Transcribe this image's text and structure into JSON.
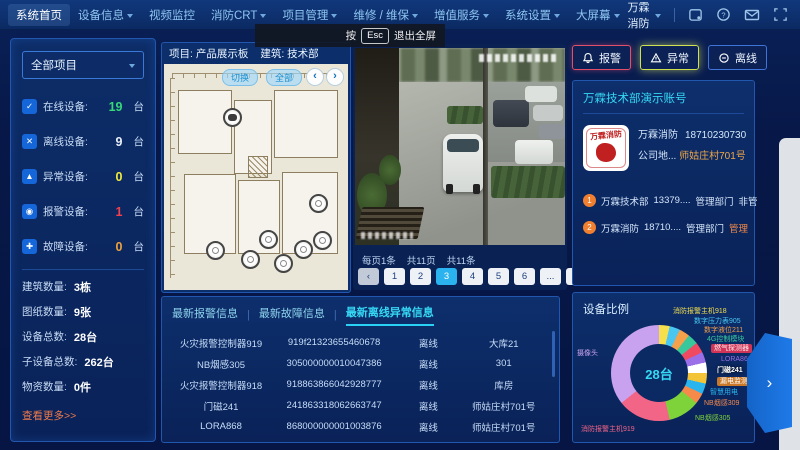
{
  "nav": {
    "items": [
      {
        "label": "系统首页"
      },
      {
        "label": "设备信息"
      },
      {
        "label": "视频监控"
      },
      {
        "label": "消防CRT"
      },
      {
        "label": "项目管理"
      },
      {
        "label": "维修 / 维保"
      },
      {
        "label": "增值服务"
      },
      {
        "label": "系统设置"
      },
      {
        "label": "大屏幕"
      }
    ],
    "user": "万霖消防",
    "icon_names": [
      "notification-icon",
      "help-icon",
      "mail-icon",
      "fullscreen-icon"
    ]
  },
  "tooltip": {
    "press": "按",
    "key": "Esc",
    "action": "退出全屏"
  },
  "sidebar": {
    "project_selector": "全部项目",
    "stats": [
      {
        "label": "在线设备:",
        "value": "19",
        "unit": "台",
        "color": "#35d977",
        "glyph": "✓"
      },
      {
        "label": "离线设备:",
        "value": "9",
        "unit": "台",
        "color": "#e9eff6",
        "glyph": "✕"
      },
      {
        "label": "异常设备:",
        "value": "0",
        "unit": "台",
        "color": "#f2ec3a",
        "glyph": "▲"
      },
      {
        "label": "报警设备:",
        "value": "1",
        "unit": "台",
        "color": "#f0414e",
        "glyph": "◉"
      },
      {
        "label": "故障设备:",
        "value": "0",
        "unit": "台",
        "color": "#f0a23a",
        "glyph": "✚"
      }
    ],
    "summary": [
      {
        "label": "建筑数量:",
        "value": "3栋"
      },
      {
        "label": "图纸数量:",
        "value": "9张"
      },
      {
        "label": "设备总数:",
        "value": "28台"
      },
      {
        "label": "子设备总数:",
        "value": "262台"
      },
      {
        "label": "物资数量:",
        "value": "0件"
      }
    ],
    "more_link": "查看更多>>"
  },
  "plan": {
    "project": "项目: 产品展示板",
    "building": "建筑: 技术部",
    "switch_btn": "切换",
    "all_btn": "全部",
    "prev": "‹",
    "next": "›"
  },
  "pagination": {
    "per_page": "每页1条",
    "total_pages": "共11页",
    "total_items": "共11条",
    "prev": "‹",
    "pages": [
      "1",
      "2",
      "3",
      "4",
      "5",
      "6",
      "...",
      "11"
    ],
    "active_page": "3",
    "next": "›"
  },
  "tabs": {
    "separator": "|",
    "items": [
      "最新报警信息",
      "最新故障信息",
      "最新离线异常信息"
    ]
  },
  "table": {
    "rows": [
      {
        "name": "火灾报警控制器919",
        "id": "919f21323655460678",
        "status": "离线",
        "location": "大库21"
      },
      {
        "name": "NB烟感305",
        "id": "305000000010047386",
        "status": "离线",
        "location": "301"
      },
      {
        "name": "火灾报警控制器918",
        "id": "918863866042928777",
        "status": "离线",
        "location": "库房"
      },
      {
        "name": "门磁241",
        "id": "241863318062663747",
        "status": "离线",
        "location": "师姑庄村701号"
      },
      {
        "name": "LORA868",
        "id": "868000000001003876",
        "status": "离线",
        "location": "师姑庄村701号"
      }
    ]
  },
  "right_buttons": [
    {
      "label": "报警",
      "icon": "alarm-bell-icon",
      "accent": "#e0506a"
    },
    {
      "label": "异常",
      "icon": "warning-triangle-icon",
      "accent": "#cfe050"
    },
    {
      "label": "离线",
      "icon": "circle-minus-icon",
      "accent": "#3f74d8"
    }
  ],
  "account": {
    "title": "万霖技术部演示账号",
    "logo_text": "万霖消防",
    "company": "万霖消防",
    "phone": "18710230730",
    "address_label": "公司地...",
    "address": "师姑庄村701号",
    "members": [
      {
        "num": "1",
        "name": "万霖技术部",
        "phone": "13379....",
        "dept": "管理部门",
        "role": "非管"
      },
      {
        "num": "2",
        "name": "万霖消防",
        "phone": "18710....",
        "dept": "管理部门",
        "role": "管理"
      }
    ]
  },
  "chart_data": {
    "type": "pie",
    "subtype": "donut",
    "title": "设备比例",
    "center_label": "28台",
    "total": 28,
    "legend_position": "around",
    "slices": [
      {
        "label": "消防报警主机918",
        "value": 1,
        "color": "#f5df4d"
      },
      {
        "label": "数字压力表905",
        "value": 1,
        "color": "#49c6f2"
      },
      {
        "label": "数字液位211",
        "value": 1,
        "color": "#f5a04a"
      },
      {
        "label": "4G控制模块",
        "value": 1,
        "color": "#39c89b"
      },
      {
        "label": "燃气探测器",
        "value": 1,
        "color": "#ef4a62"
      },
      {
        "label": "LORA868",
        "value": 1,
        "color": "#9a6fe8"
      },
      {
        "label": "门磁241",
        "value": 1,
        "color": "#ffffff"
      },
      {
        "label": "漏电监测",
        "value": 1,
        "color": "#f3c438"
      },
      {
        "label": "智慧用电",
        "value": 1,
        "color": "#2ab5ee"
      },
      {
        "label": "NB烟感309",
        "value": 1,
        "color": "#f58a4a"
      },
      {
        "label": "NB烟感305",
        "value": 3,
        "color": "#7ed33b"
      },
      {
        "label": "消防报警主机919",
        "value": 5,
        "color": "#f26587"
      },
      {
        "label": "摄像头",
        "value": 10,
        "color": "#c9a2ef"
      }
    ]
  },
  "slide_tab": {
    "arrow": "›"
  }
}
